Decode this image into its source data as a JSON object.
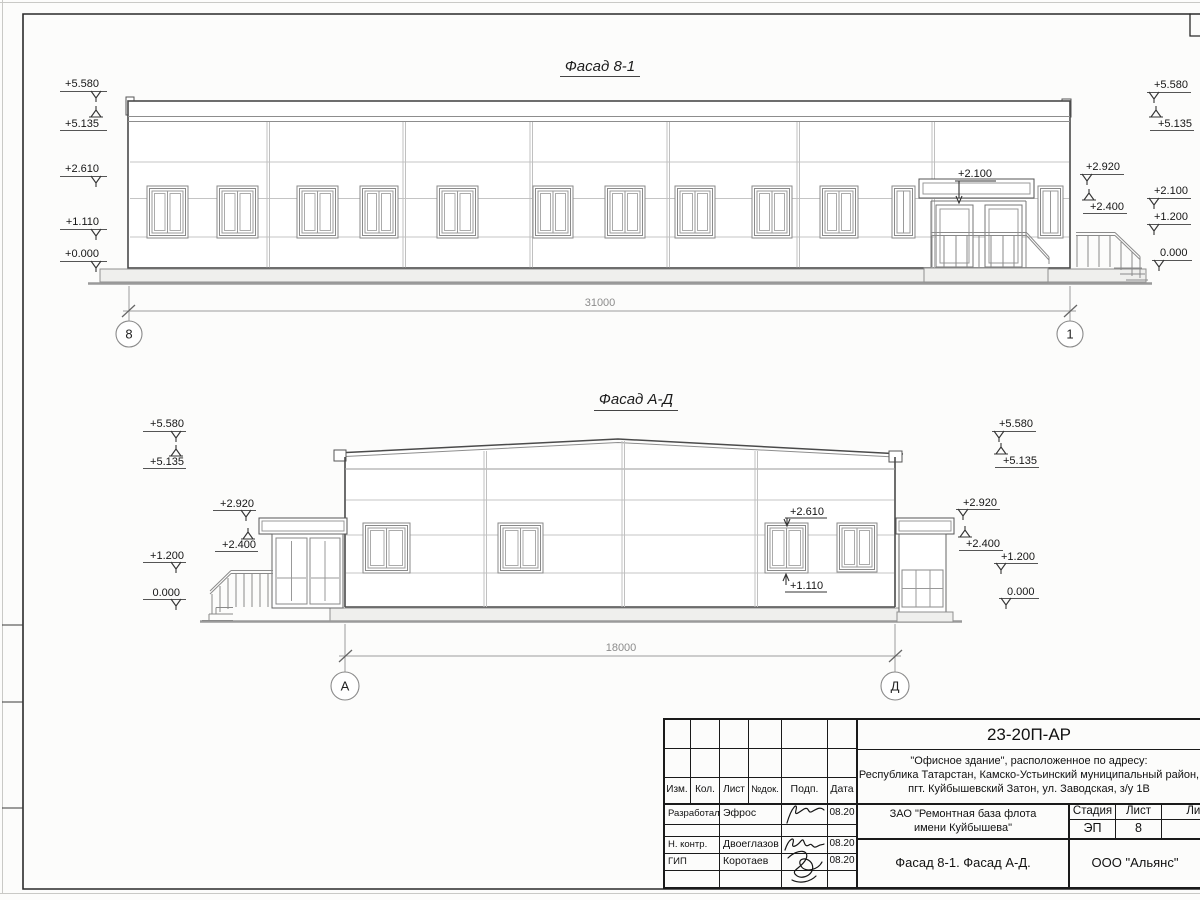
{
  "sheet": {
    "facade1": {
      "title": "Фасад 8-1",
      "dimension": "31000",
      "axis_left": "8",
      "axis_right": "1",
      "marks": {
        "L0": "+5.580",
        "L1": "+5.135",
        "L2": "+2.610",
        "L3": "+1.110",
        "L4": "+0.000",
        "RN0": "+2.920",
        "RN1": "+2.400",
        "RF0": "+5.580",
        "RF1": "+5.135",
        "RF2": "+2.100",
        "RF3": "+1.200",
        "RF4": "0.000",
        "door": "+2.100"
      }
    },
    "facade2": {
      "title": "Фасад А-Д",
      "dimension": "18000",
      "axis_left": "А",
      "axis_right": "Д",
      "marks": {
        "L0": "+5.580",
        "L1": "+5.135",
        "L2": "+1.200",
        "L3": "0.000",
        "LN0": "+2.920",
        "LN1": "+2.400",
        "RN0": "+2.920",
        "RN1": "+2.400",
        "RF0": "+5.580",
        "RF1": "+5.135",
        "RF2": "+1.200",
        "RF3": "0.000",
        "win_top": "+2.610",
        "win_bot": "+1.110"
      }
    }
  },
  "titleblock": {
    "doc_number": "23-20П-АР",
    "address": [
      "\"Офисное здание\", расположенное по адресу:",
      "Республика Татарстан, Камско-Устьинский муниципальный район,",
      "пгт. Куйбышевский Затон, ул. Заводская, з/у 1В"
    ],
    "client": [
      "ЗАО \"Ремонтная база флота",
      "имени Куйбышева\""
    ],
    "sheet_title": "Фасад 8-1. Фасад А-Д.",
    "company": "ООО \"Альянс\"",
    "columns": {
      "izm": "Изм.",
      "kol": "Кол.",
      "list": "Лист",
      "ndok": "№док.",
      "podp": "Подп.",
      "data": "Дата"
    },
    "stage": {
      "label": "Стадия",
      "value": "ЭП"
    },
    "sheet_col": {
      "label": "Лист",
      "value": "8"
    },
    "sheets_col": {
      "label": "Листов",
      "value": ""
    },
    "rows": [
      {
        "role": "Разработал",
        "name": "Эфрос",
        "date": "08.20"
      },
      {
        "role": "Н. контр.",
        "name": "Двоеглазов",
        "date": "08.20"
      },
      {
        "role": "ГИП",
        "name": "Коротаев",
        "date": "08.20"
      }
    ],
    "colors": {
      "line": "#1a1a1a",
      "dim": "#8c8c8c"
    }
  }
}
